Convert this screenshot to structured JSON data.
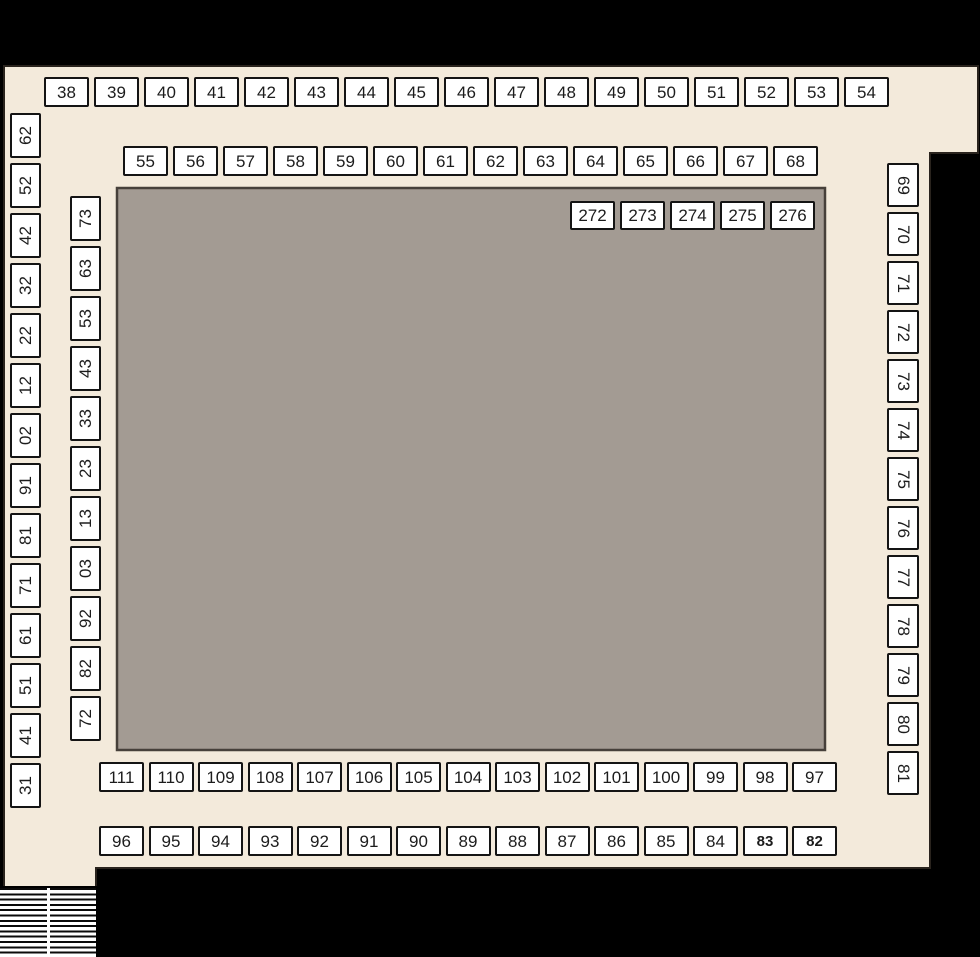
{
  "colors": {
    "background": "#000000",
    "floor": "#f3eadb",
    "hall": "#a39b93",
    "booth_fill": "#ffffff",
    "booth_border": "#141414"
  },
  "booths": {
    "top": [
      "38",
      "39",
      "40",
      "41",
      "42",
      "43",
      "44",
      "45",
      "46",
      "47",
      "48",
      "49",
      "50",
      "51",
      "52",
      "53",
      "54"
    ],
    "upper_inner": [
      "55",
      "56",
      "57",
      "58",
      "59",
      "60",
      "61",
      "62",
      "63",
      "64",
      "65",
      "66",
      "67",
      "68"
    ],
    "hall_inner": [
      "272",
      "273",
      "274",
      "275",
      "276"
    ],
    "left_outer": [
      "26",
      "25",
      "24",
      "23",
      "22",
      "21",
      "20",
      "19",
      "18",
      "17",
      "16",
      "15",
      "14",
      "13"
    ],
    "left_inner": [
      "37",
      "36",
      "35",
      "34",
      "33",
      "32",
      "31",
      "30",
      "29",
      "28",
      "27"
    ],
    "right": [
      "69",
      "70",
      "71",
      "72",
      "73",
      "74",
      "75",
      "76",
      "77",
      "78",
      "79",
      "80",
      "81"
    ],
    "bottom_inner": [
      "111",
      "110",
      "109",
      "108",
      "107",
      "106",
      "105",
      "104",
      "103",
      "102",
      "101",
      "100",
      "99",
      "98",
      "97"
    ],
    "bottom_outer": [
      "96",
      "95",
      "94",
      "93",
      "92",
      "91",
      "90",
      "89",
      "88",
      "87",
      "86",
      "85",
      "84",
      "83",
      "82"
    ]
  }
}
